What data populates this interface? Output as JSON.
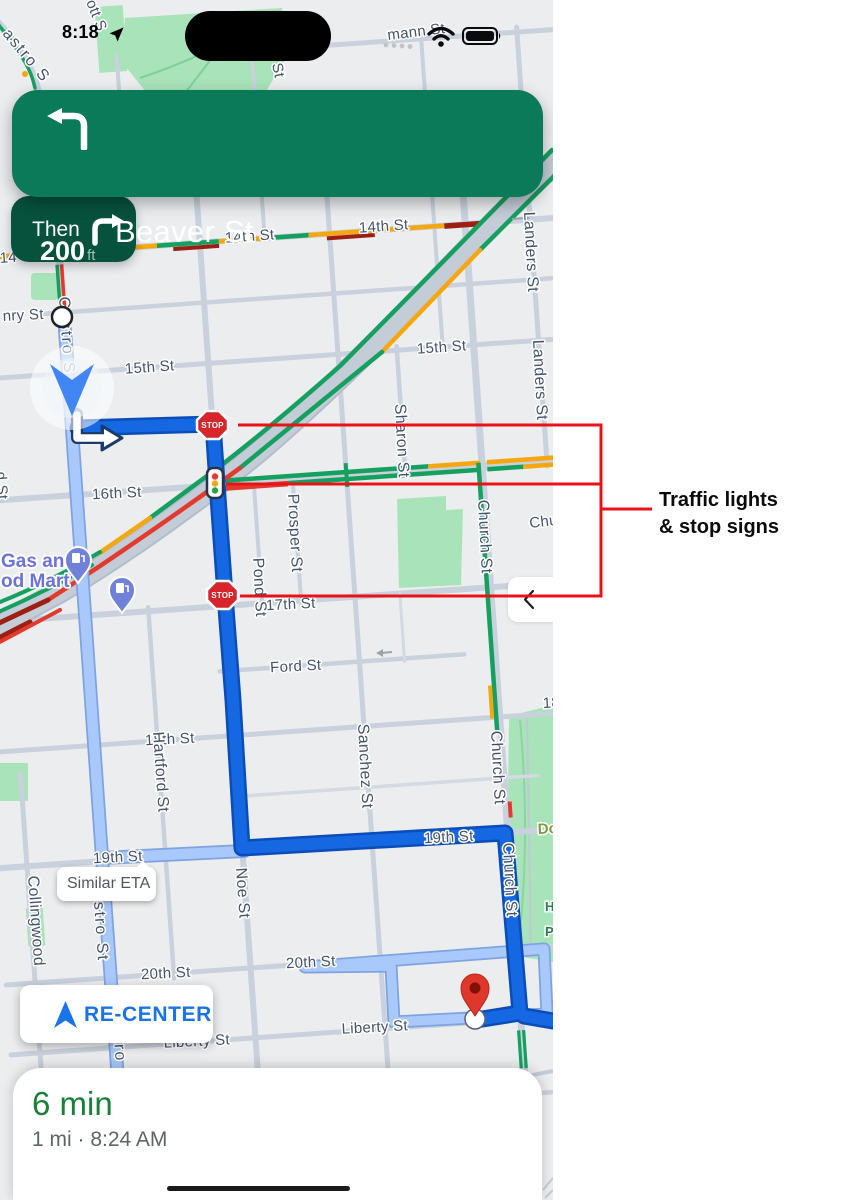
{
  "status_bar": {
    "time": "8:18"
  },
  "navigation": {
    "distance": "200",
    "distance_unit": "ft",
    "instruction": "Beaver St",
    "then_label": "Then"
  },
  "map": {
    "stop_sign_label": "STOP",
    "similar_eta_label": "Similar ETA",
    "labels": {
      "castro_diag": "astro S",
      "ott": "ott S",
      "st_frag": "St",
      "hermann": "mann St",
      "h14_a": "14th St",
      "h14_b": "14th St",
      "h14_frag": "14",
      "henry": "nry St",
      "h15_a": "15th St",
      "h15_b": "15th St",
      "h16": "16th St",
      "h17": "17th St",
      "ford": "Ford St",
      "h18": "18th St",
      "h18_frag": "18",
      "h19_a": "19th St",
      "h19_b": "19th St",
      "h20_a": "20th St",
      "h20_b": "20th St",
      "liberty_a": "Liberty St",
      "liberty_b": "Liberty St",
      "collingwood": "Collingwood",
      "castro_up": "Castro S",
      "castro_mid": "stro St",
      "castro_low": "tro",
      "hartford": "Hartford St",
      "noe": "Noe St",
      "pond": "Pond St",
      "prosper": "Prosper St",
      "sanchez": "Sanchez St",
      "sharon": "Sharon St",
      "church_a": "Church St",
      "church_b": "Church St",
      "church_c": "Church St",
      "landers_a": "Landers St",
      "landers_b": "Landers St",
      "d_st": "d St",
      "chu": "Chu",
      "dol": "Dol",
      "hp_h": "H",
      "hp_p": "P",
      "gas1": "Gas and",
      "gas2": "od Mart"
    }
  },
  "recenter_label": "RE-CENTER",
  "bottom_sheet": {
    "eta": "6 min",
    "details": "1 mi · 8:24 AM"
  },
  "annotation": {
    "line1": "Traffic lights",
    "line2": "& stop signs"
  },
  "colors": {
    "banner_green": "#0B7A59",
    "then_green": "#07523C",
    "route_blue": "#1567E2",
    "alt_route_blue": "#A9C8FB",
    "traffic_green": "#15A060",
    "traffic_yellow": "#F4A70F",
    "traffic_red": "#E33A2E",
    "traffic_dark_red": "#9C1F14",
    "recenter_blue": "#1A73E8",
    "eta_green": "#188038",
    "annotation_red": "#E81219",
    "park_green": "#A9E3BA"
  }
}
